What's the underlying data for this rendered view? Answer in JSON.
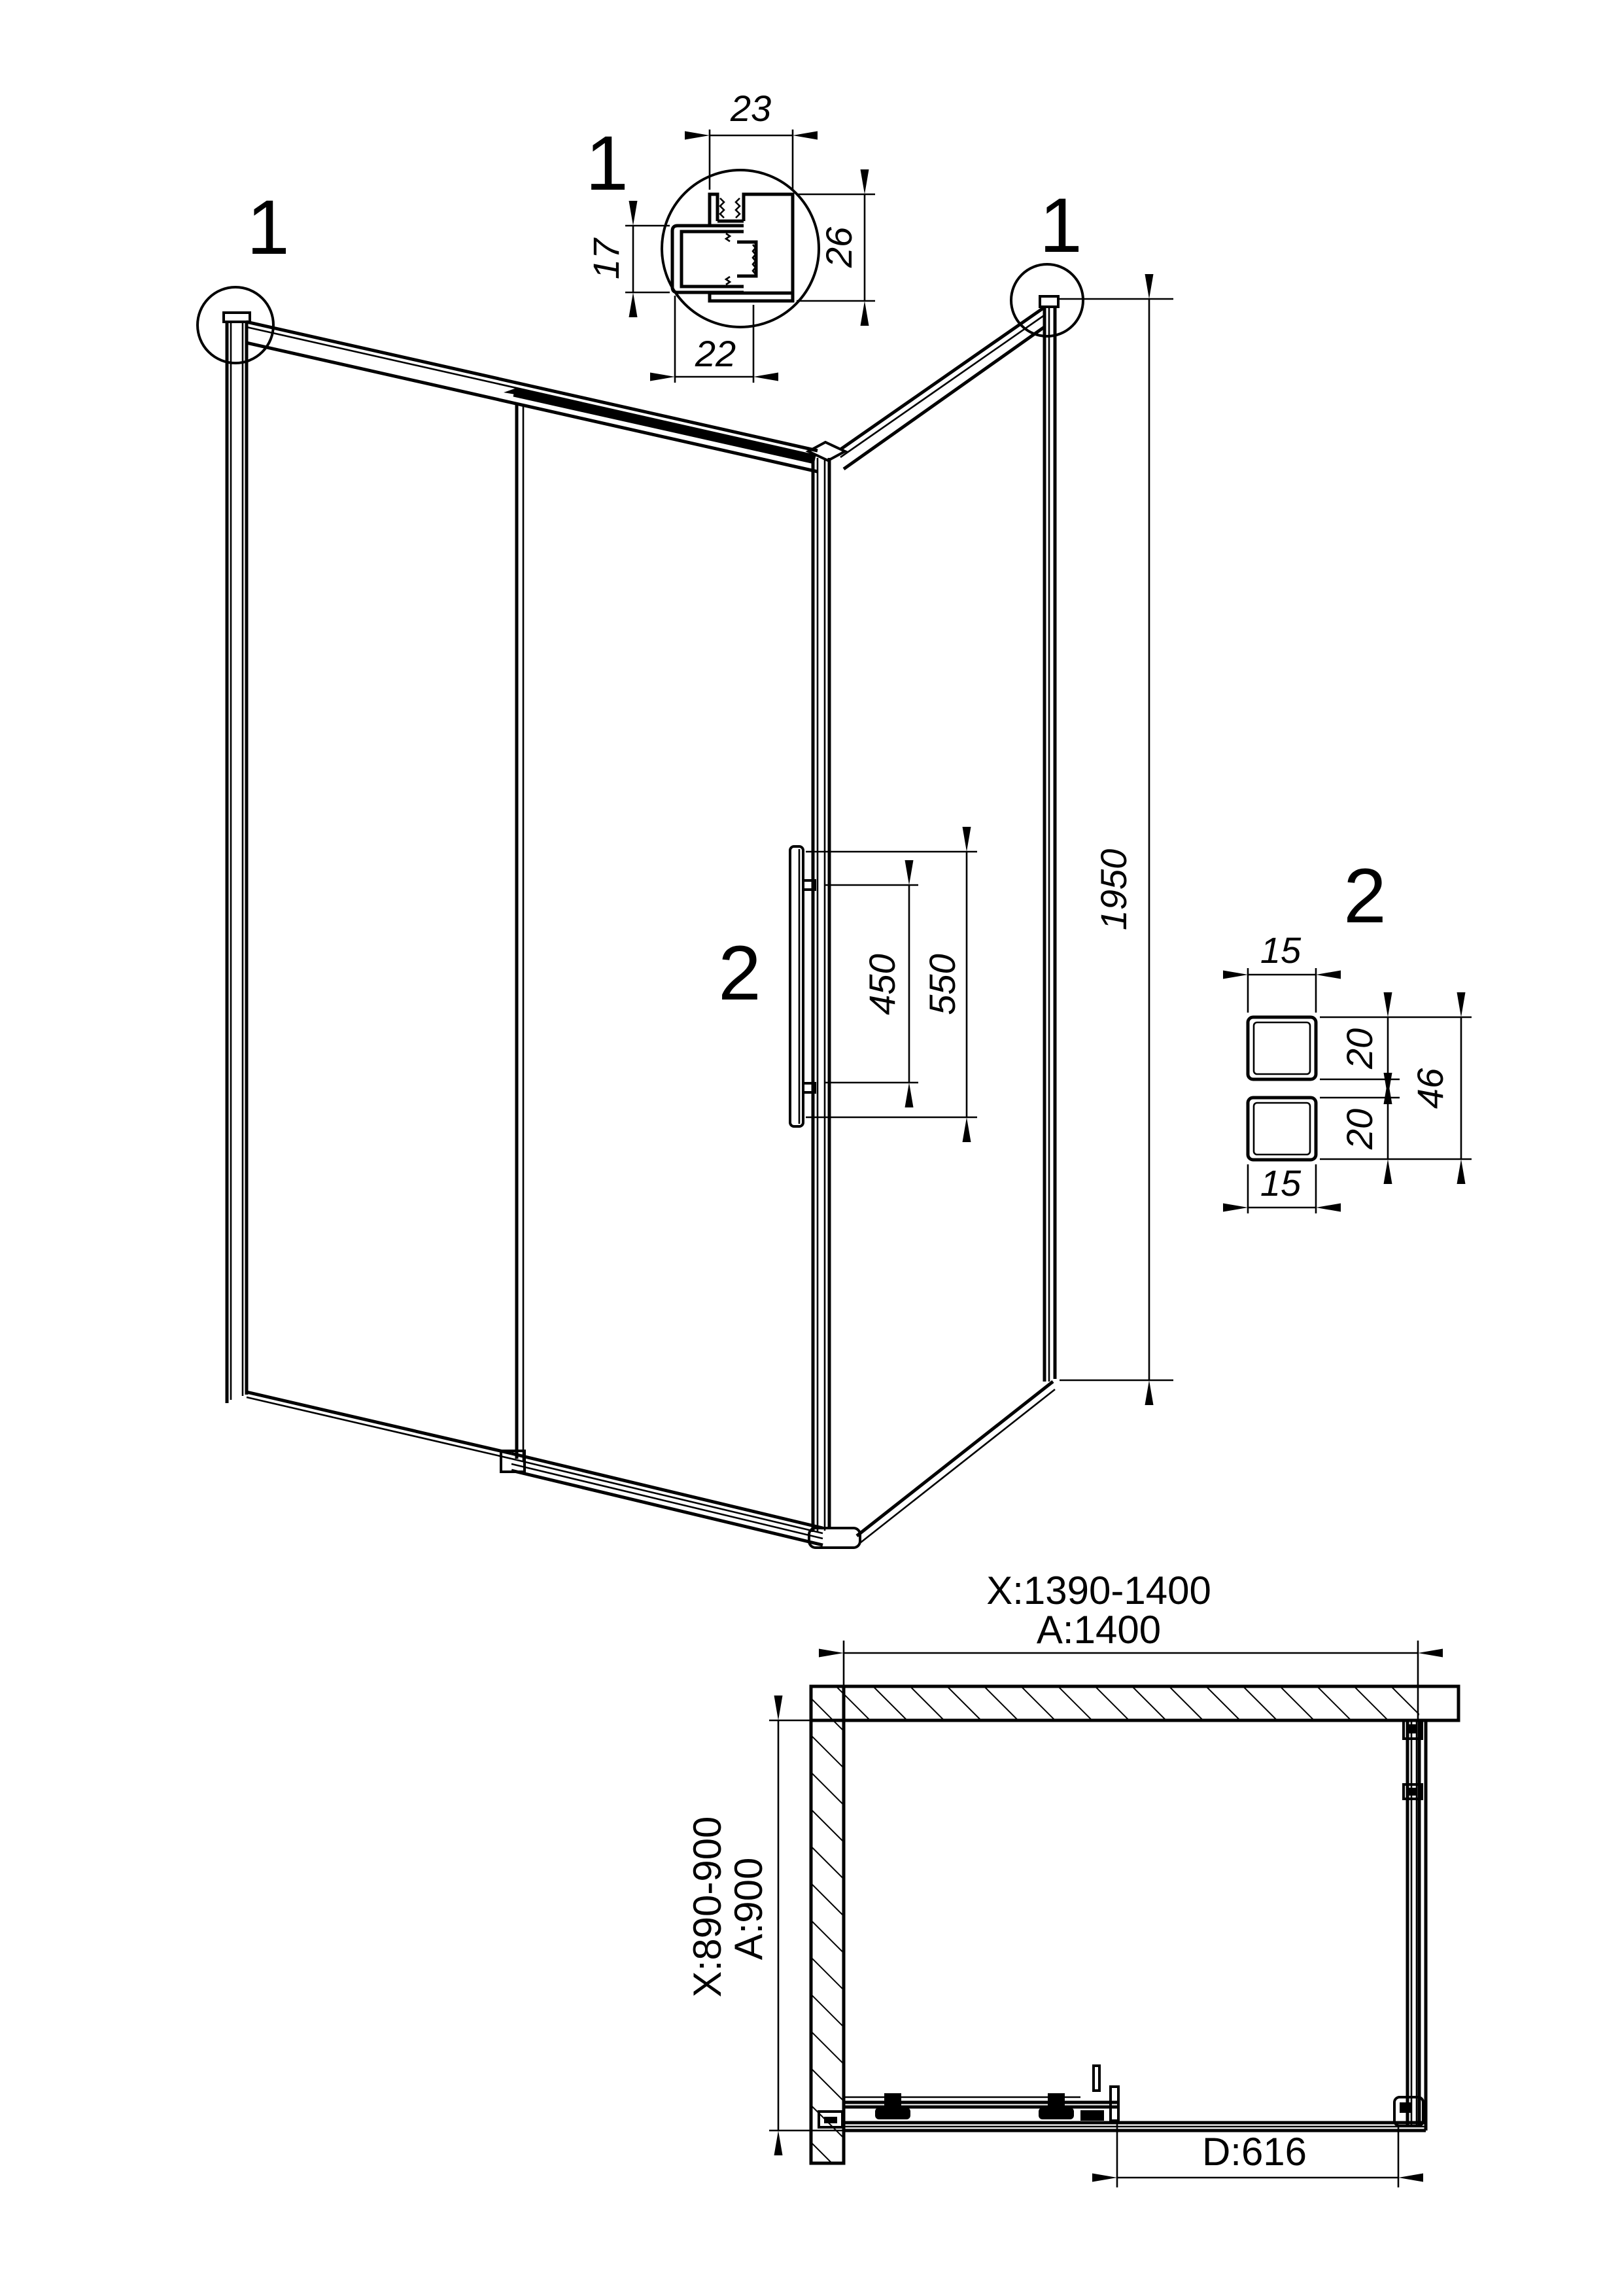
{
  "page": {
    "background": "#ffffff",
    "line_color": "#000000"
  },
  "detail1": {
    "label": "1",
    "dim_top": "23",
    "dim_right": "26",
    "dim_left": "17",
    "dim_bottom": "22"
  },
  "main_view": {
    "callout_left": "1",
    "callout_right": "1",
    "dim_height": "1950",
    "handle_label": "2",
    "dim_handle_inner": "450",
    "dim_handle_outer": "550"
  },
  "detail2": {
    "label": "2",
    "dim_top": "15",
    "dim_upper": "20",
    "dim_total": "46",
    "dim_lower": "20",
    "dim_bottom": "15"
  },
  "plan": {
    "dim_width_range": "X:1390-1400",
    "dim_width": "A:1400",
    "dim_depth_range": "X:890-900",
    "dim_depth": "A:900",
    "dim_door": "D:616"
  }
}
